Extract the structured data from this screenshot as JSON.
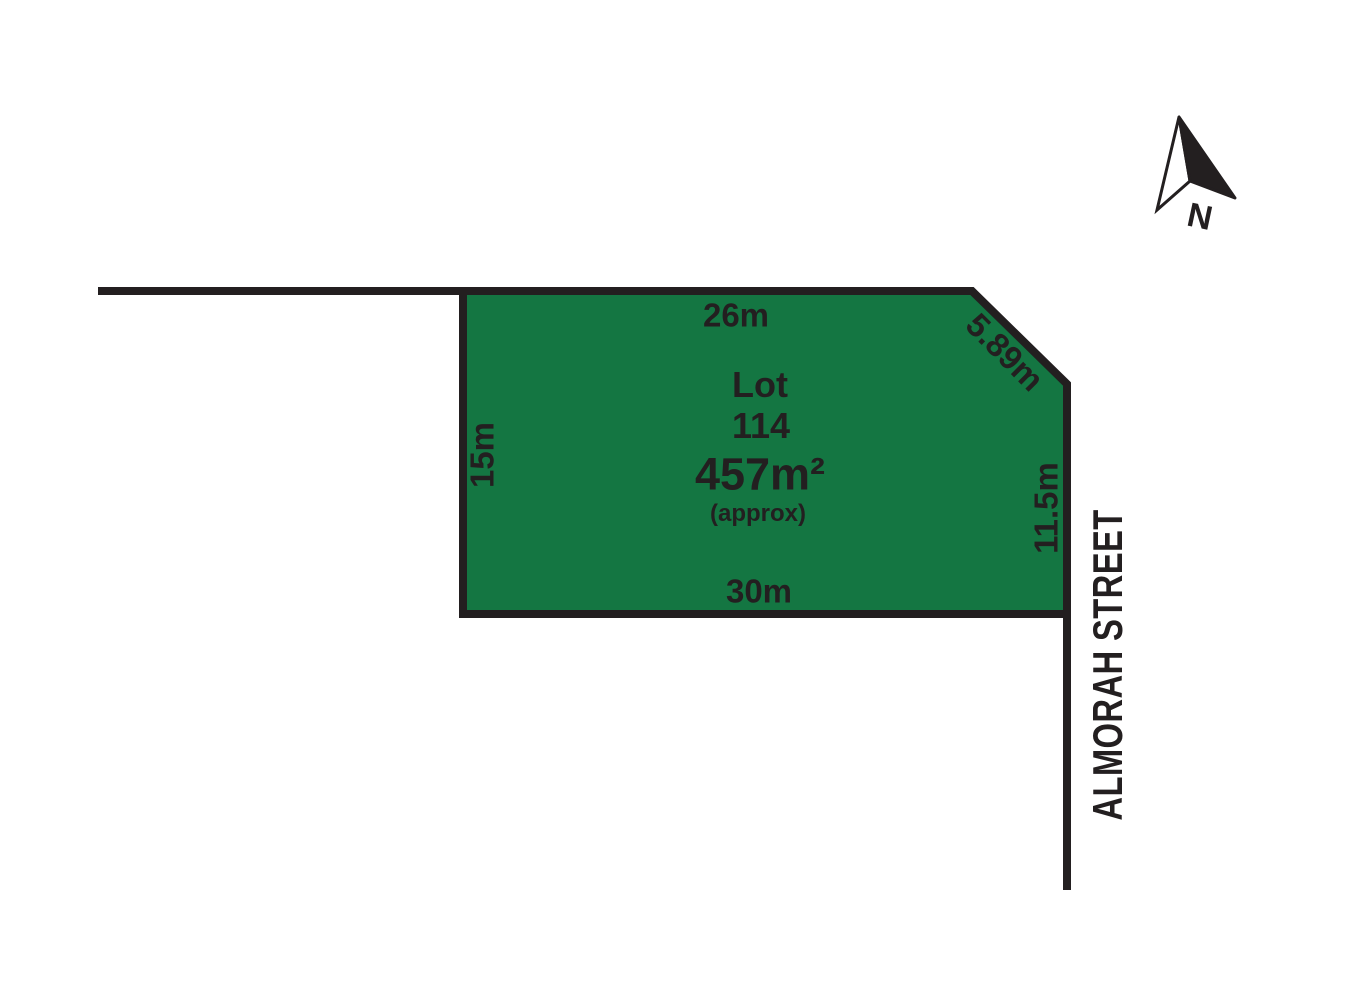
{
  "plan": {
    "lot_label": "Lot",
    "lot_number": "114",
    "area": "457m²",
    "area_qualifier": "(approx)",
    "dimensions": {
      "top": "26m",
      "corner": "5.89m",
      "left": "15m",
      "right": "11.5m",
      "bottom": "30m"
    },
    "street": "ALMORAH STREET",
    "compass": {
      "label": "N"
    },
    "colors": {
      "lot_fill": "#147642",
      "line": "#231f20",
      "background": "#ffffff"
    }
  }
}
